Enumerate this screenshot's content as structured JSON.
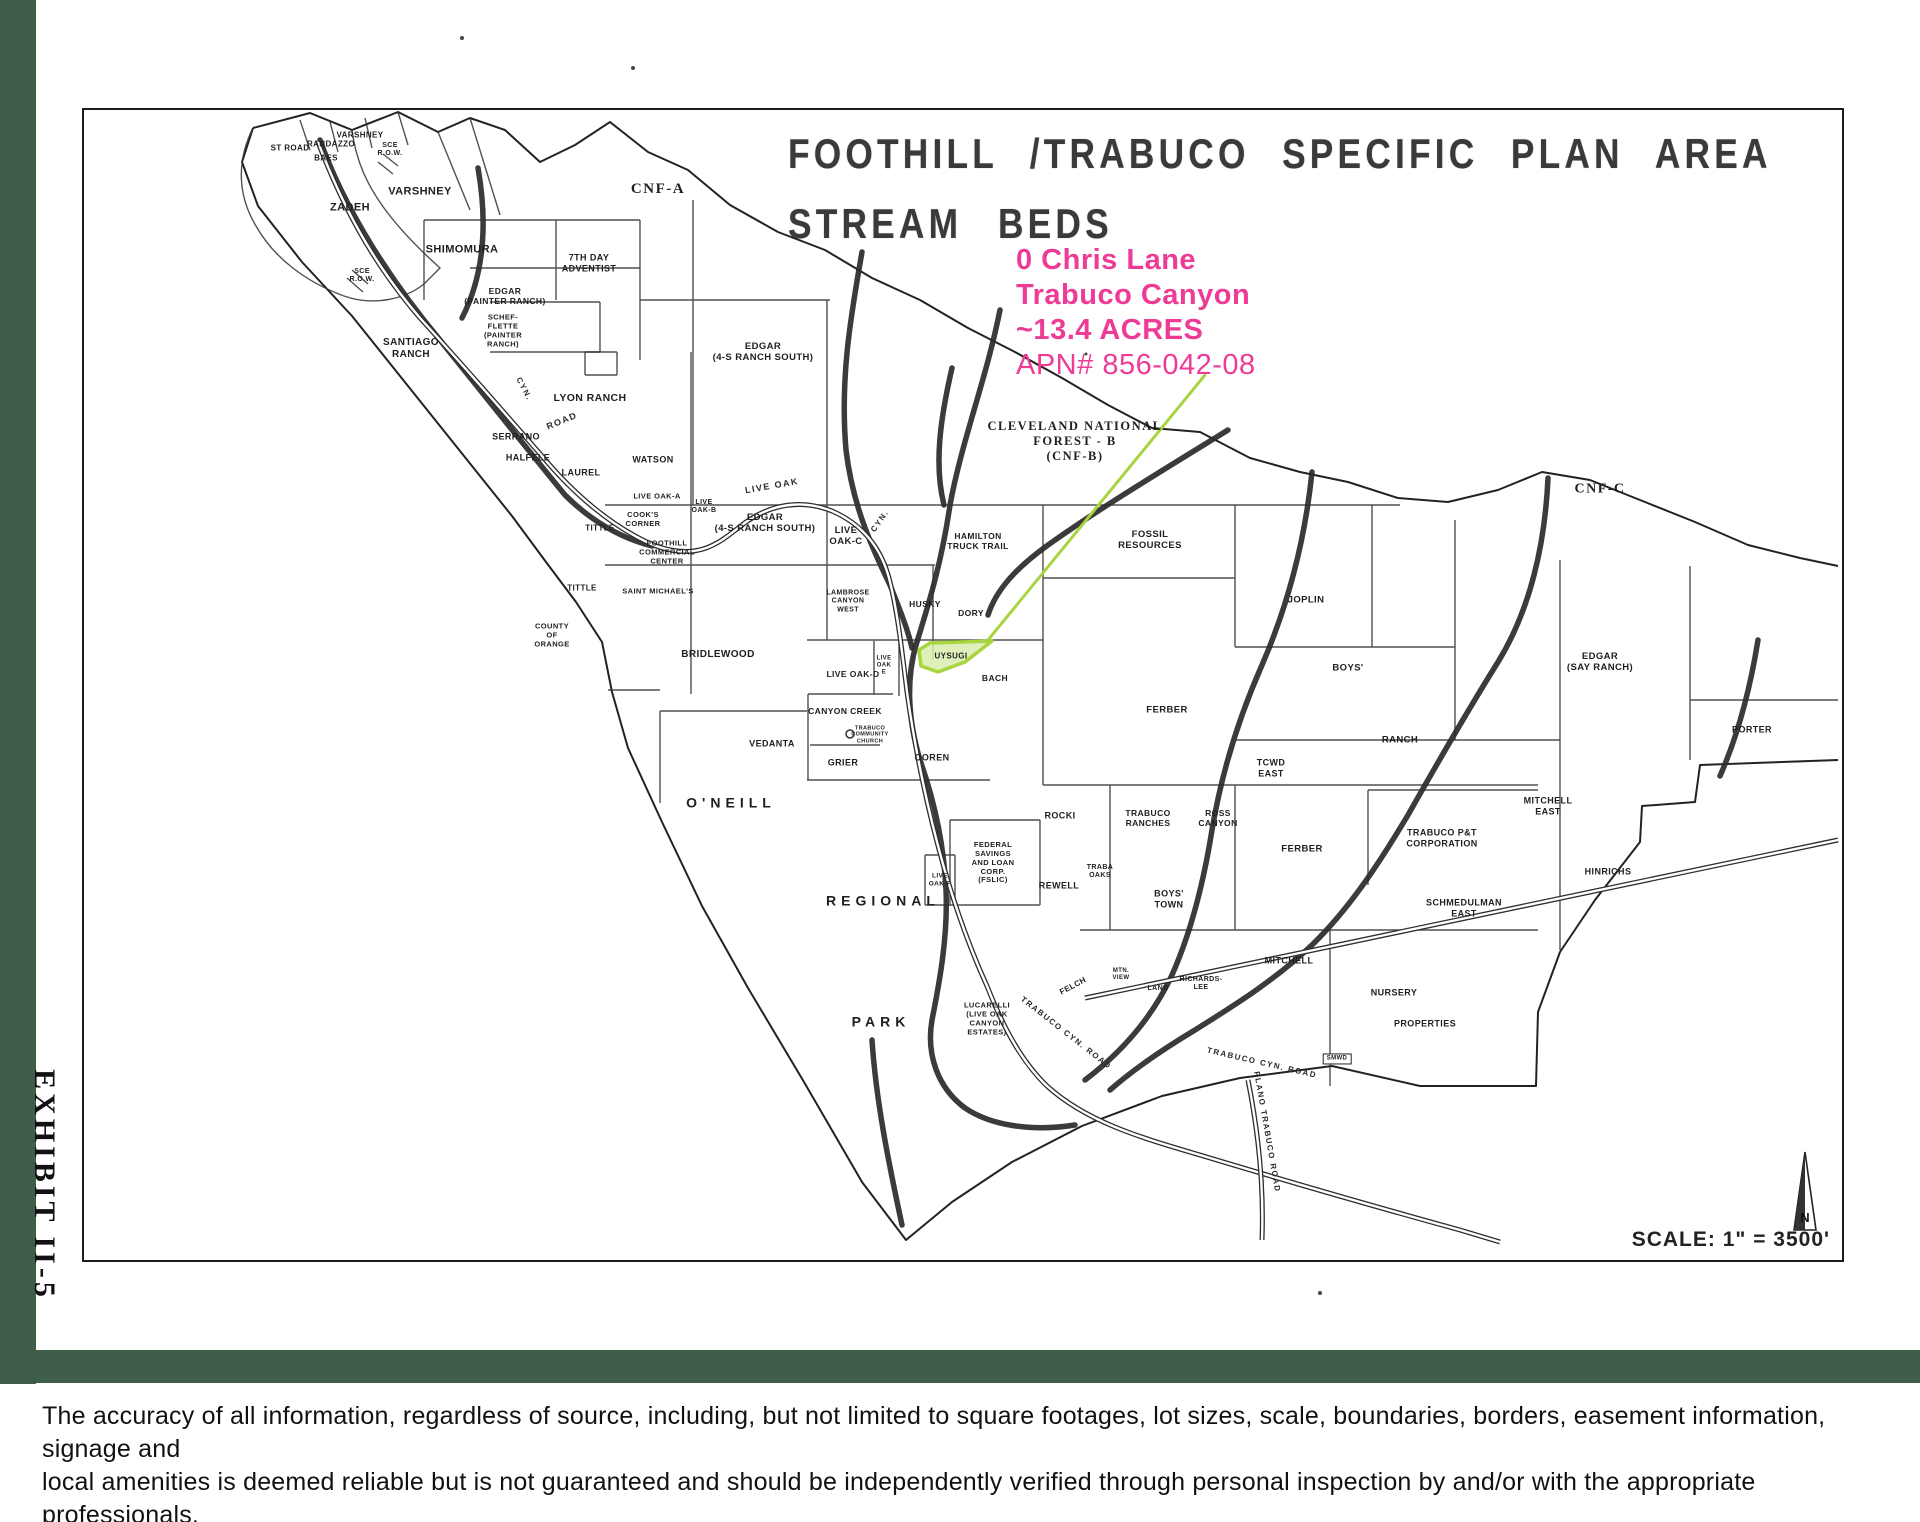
{
  "colors": {
    "bar_green": "#3f5e4a",
    "pink": "#ed3b96",
    "highlight_fill": "#d8ecad",
    "highlight_stroke": "#a8d53e",
    "leader_green": "#a8d53e"
  },
  "exhibit_label": "EXHIBIT II-5",
  "map": {
    "title_line1": "FOOTHILL /TRABUCO SPECIFIC PLAN AREA",
    "title_line2": "STREAM BEDS",
    "annotation": {
      "lines": [
        "0 Chris Lane",
        "Trabuco Canyon",
        "~13.4 ACRES",
        "APN# 856-042-08"
      ]
    },
    "scale_text": "SCALE: 1\" =   3500'",
    "north_label": "N",
    "highlighted_parcel": "UYSUGI",
    "labels": [
      {
        "t": "ST ROAD",
        "x": 290,
        "y": 148,
        "s": 8
      },
      {
        "t": "RANDAZZO",
        "x": 331,
        "y": 144,
        "s": 8
      },
      {
        "t": "BAES",
        "x": 326,
        "y": 158,
        "s": 8
      },
      {
        "t": "VARSHNEY",
        "x": 360,
        "y": 135,
        "s": 8
      },
      {
        "t": "SCE\nR.O.W.",
        "x": 390,
        "y": 150,
        "s": 7
      },
      {
        "t": "ZADEH",
        "x": 350,
        "y": 208,
        "s": 11
      },
      {
        "t": "VARSHNEY",
        "x": 420,
        "y": 192,
        "s": 11
      },
      {
        "t": "SHIMOMURA",
        "x": 462,
        "y": 250,
        "s": 11
      },
      {
        "t": "CNF-A",
        "x": 658,
        "y": 190,
        "s": 15,
        "c": "serif"
      },
      {
        "t": "SCE\nR.O.W.",
        "x": 362,
        "y": 276,
        "s": 7
      },
      {
        "t": "7TH DAY\nADVENTIST",
        "x": 589,
        "y": 263,
        "s": 9
      },
      {
        "t": "EDGAR\n(PAINTER RANCH)",
        "x": 505,
        "y": 296,
        "s": 8.5
      },
      {
        "t": "SCHEF-\nFLETTE\n(PAINTER\nRANCH)",
        "x": 503,
        "y": 331,
        "s": 7.5
      },
      {
        "t": "SANTIAGO\nRANCH",
        "x": 411,
        "y": 349,
        "s": 10
      },
      {
        "t": "LYON RANCH",
        "x": 590,
        "y": 398,
        "s": 10.5
      },
      {
        "t": "SERRANO",
        "x": 516,
        "y": 437,
        "s": 9
      },
      {
        "t": "HALFELE",
        "x": 528,
        "y": 458,
        "s": 9
      },
      {
        "t": "LAUREL",
        "x": 581,
        "y": 473,
        "s": 9
      },
      {
        "t": "WATSON",
        "x": 653,
        "y": 460,
        "s": 9
      },
      {
        "t": "EDGAR\n(4-S RANCH SOUTH)",
        "x": 763,
        "y": 352,
        "s": 9.5
      },
      {
        "t": "CLEVELAND NATIONAL\nFOREST - B\n(CNF-B)",
        "x": 1075,
        "y": 441,
        "s": 12.5,
        "c": "serif"
      },
      {
        "t": "LIVE OAK-A",
        "x": 657,
        "y": 497,
        "s": 7.5
      },
      {
        "t": "LIVE\nOAK-B",
        "x": 704,
        "y": 507,
        "s": 7
      },
      {
        "t": "COOK'S\nCORNER",
        "x": 643,
        "y": 520,
        "s": 7.5
      },
      {
        "t": "FOOTHILL\nCOMMERCIAL\nCENTER",
        "x": 667,
        "y": 553,
        "s": 7.5
      },
      {
        "t": "TITTLE",
        "x": 600,
        "y": 528,
        "s": 8
      },
      {
        "t": "EDGAR\n(4-S RANCH SOUTH)",
        "x": 765,
        "y": 523,
        "s": 9.5
      },
      {
        "t": "LIVE\nOAK-C",
        "x": 846,
        "y": 536,
        "s": 9.5
      },
      {
        "t": "LIVE OAK",
        "x": 772,
        "y": 486,
        "s": 9,
        "r": -10,
        "c": "road"
      },
      {
        "t": "CYN.",
        "x": 880,
        "y": 521,
        "s": 8,
        "r": -55,
        "c": "road"
      },
      {
        "t": "CYN.",
        "x": 524,
        "y": 389,
        "s": 8,
        "r": 62,
        "c": "road"
      },
      {
        "t": "ROAD",
        "x": 562,
        "y": 421,
        "s": 9,
        "r": -22,
        "c": "road"
      },
      {
        "t": "HAMILTON\nTRUCK TRAIL",
        "x": 978,
        "y": 541,
        "s": 8.5
      },
      {
        "t": "FOSSIL\nRESOURCES",
        "x": 1150,
        "y": 540,
        "s": 9.5
      },
      {
        "t": "JOPLIN",
        "x": 1306,
        "y": 600,
        "s": 9.5
      },
      {
        "t": "CNF-C",
        "x": 1600,
        "y": 490,
        "s": 14,
        "c": "serif"
      },
      {
        "t": "TITTLE",
        "x": 582,
        "y": 588,
        "s": 8
      },
      {
        "t": "SAINT MICHAEL'S",
        "x": 658,
        "y": 592,
        "s": 7.5
      },
      {
        "t": "COUNTY\nOF\nORANGE",
        "x": 552,
        "y": 636,
        "s": 7.5
      },
      {
        "t": "BRIDLEWOOD",
        "x": 718,
        "y": 655,
        "s": 10
      },
      {
        "t": "LAMBROSE\nCANYON\nWEST",
        "x": 848,
        "y": 602,
        "s": 7
      },
      {
        "t": "HUSKY",
        "x": 925,
        "y": 604,
        "s": 8.5
      },
      {
        "t": "DORY",
        "x": 971,
        "y": 613,
        "s": 8.5
      },
      {
        "t": "UYSUGI",
        "x": 951,
        "y": 656,
        "s": 8
      },
      {
        "t": "BACH",
        "x": 995,
        "y": 678,
        "s": 8.5
      },
      {
        "t": "LIVE OAK-D",
        "x": 853,
        "y": 674,
        "s": 8.5
      },
      {
        "t": "LIVE\nOAK\nE",
        "x": 884,
        "y": 666,
        "s": 6
      },
      {
        "t": "CANYON CREEK",
        "x": 845,
        "y": 711,
        "s": 8.5
      },
      {
        "t": "TRABUCO\nCOMMUNITY\nCHURCH",
        "x": 870,
        "y": 735,
        "s": 5.5
      },
      {
        "t": "VEDANTA",
        "x": 772,
        "y": 744,
        "s": 9
      },
      {
        "t": "GRIER",
        "x": 843,
        "y": 763,
        "s": 9
      },
      {
        "t": "OOREN",
        "x": 932,
        "y": 758,
        "s": 9
      },
      {
        "t": "O'NEILL",
        "x": 731,
        "y": 803,
        "s": 14,
        "c": "spaced"
      },
      {
        "t": "FERBER",
        "x": 1167,
        "y": 710,
        "s": 9.5
      },
      {
        "t": "TCWD\nEAST",
        "x": 1271,
        "y": 768,
        "s": 9
      },
      {
        "t": "BOYS'",
        "x": 1348,
        "y": 668,
        "s": 9.5
      },
      {
        "t": "RANCH",
        "x": 1400,
        "y": 740,
        "s": 9.5
      },
      {
        "t": "EDGAR\n(SAY RANCH)",
        "x": 1600,
        "y": 662,
        "s": 9.5
      },
      {
        "t": "PORTER",
        "x": 1752,
        "y": 730,
        "s": 9
      },
      {
        "t": "MITCHELL\nEAST",
        "x": 1548,
        "y": 806,
        "s": 9
      },
      {
        "t": "HINRICHS",
        "x": 1608,
        "y": 872,
        "s": 9
      },
      {
        "t": "TRABUCO P&T\nCORPORATION",
        "x": 1442,
        "y": 838,
        "s": 9
      },
      {
        "t": "SCHMEDULMAN\nEAST",
        "x": 1464,
        "y": 908,
        "s": 9
      },
      {
        "t": "ROCKI",
        "x": 1060,
        "y": 816,
        "s": 9
      },
      {
        "t": "TRABUCO\nRANCHES",
        "x": 1148,
        "y": 818,
        "s": 8.5
      },
      {
        "t": "ROSS\nCANYON",
        "x": 1218,
        "y": 818,
        "s": 8.5
      },
      {
        "t": "REWELL",
        "x": 1059,
        "y": 886,
        "s": 9
      },
      {
        "t": "TRABA\nOAKS",
        "x": 1100,
        "y": 872,
        "s": 7
      },
      {
        "t": "BOYS'\nTOWN",
        "x": 1169,
        "y": 899,
        "s": 9
      },
      {
        "t": "FERBER",
        "x": 1302,
        "y": 849,
        "s": 9.5
      },
      {
        "t": "FEDERAL\nSAVINGS\nAND LOAN\nCORP.\n(FSLIC)",
        "x": 993,
        "y": 863,
        "s": 7.5
      },
      {
        "t": "LIVE\nOAK-F",
        "x": 940,
        "y": 880,
        "s": 6.5
      },
      {
        "t": "REGIONAL",
        "x": 883,
        "y": 901,
        "s": 14,
        "c": "spaced"
      },
      {
        "t": "PARK",
        "x": 881,
        "y": 1022,
        "s": 14,
        "c": "spaced"
      },
      {
        "t": "LUCARELLI\n(LIVE OAK\nCANYON\nESTATES)",
        "x": 987,
        "y": 1019,
        "s": 7.5
      },
      {
        "t": "FELCH",
        "x": 1073,
        "y": 986,
        "s": 8,
        "r": -28
      },
      {
        "t": "MTN.\nVIEW",
        "x": 1121,
        "y": 975,
        "s": 6
      },
      {
        "t": "LAND",
        "x": 1158,
        "y": 989,
        "s": 7
      },
      {
        "t": "RICHARDS-\nLEE",
        "x": 1201,
        "y": 984,
        "s": 7
      },
      {
        "t": "MITCHELL",
        "x": 1289,
        "y": 961,
        "s": 9
      },
      {
        "t": "NURSERY",
        "x": 1394,
        "y": 993,
        "s": 9
      },
      {
        "t": "PROPERTIES",
        "x": 1425,
        "y": 1024,
        "s": 9
      },
      {
        "t": "SMWD",
        "x": 1337,
        "y": 1059,
        "s": 6,
        "c": "boxed"
      },
      {
        "t": "TRABUCO CYN. ROAD",
        "x": 1066,
        "y": 1033,
        "s": 8,
        "r": 38,
        "c": "road"
      },
      {
        "t": "TRABUCO CYN. ROAD",
        "x": 1262,
        "y": 1063,
        "s": 8,
        "r": 13,
        "c": "road"
      },
      {
        "t": "PLANO TRABUCO ROAD",
        "x": 1267,
        "y": 1132,
        "s": 8,
        "r": 80,
        "c": "road"
      }
    ]
  },
  "disclaimer": {
    "lines": [
      "The accuracy of all information, regardless of source, including, but not limited to square footages, lot sizes, scale, boundaries, borders, easement information, signage and",
      "local amenities is deemed reliable but is not guaranteed and should be independently verified through personal inspection by and/or with the appropriate professionals.",
      "Property listings are subject to errors, omissions, prior sales or withdrawal without notice."
    ]
  }
}
